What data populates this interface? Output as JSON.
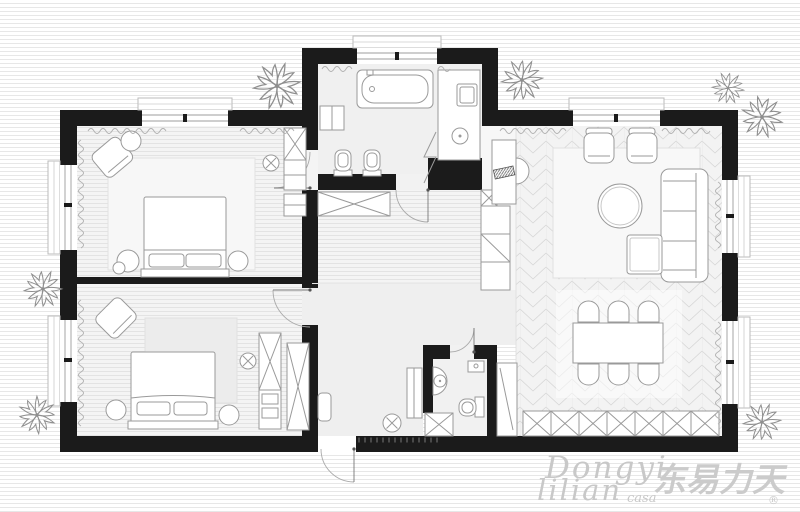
{
  "watermark": {
    "script_line1": "Dongyi",
    "script_line2": "lilian",
    "script_suffix": "casa",
    "cjk_logo": "东易力天",
    "registered_mark": "®"
  },
  "palette": {
    "wall": "#1b1b1b",
    "floor_plank": "#f4f4f4",
    "plank_line": "#dcdcdc",
    "floor_plain": "#f0f0f0",
    "chevron_line": "#d6d6d6",
    "furniture_stroke": "#9a9a9a",
    "rug": "#f8f8f8",
    "background_stripe": "#e7e7e7",
    "watermark_gray": "#c8c8c8",
    "plant_stroke": "#8f8f8f"
  },
  "plan": {
    "type": "apartment-floor-plan",
    "rooms": [
      {
        "id": "master-bedroom",
        "furniture": [
          "double-bed",
          "pillows",
          "rug",
          "armchair",
          "side-table",
          "nightstand-left",
          "nightstand-right",
          "wardrobe",
          "dresser",
          "ceiling-light"
        ]
      },
      {
        "id": "second-bedroom",
        "furniture": [
          "double-bed",
          "pillows",
          "rug",
          "armchair",
          "nightstand-left",
          "nightstand-right",
          "wardrobe",
          "wardrobe",
          "ceiling-light"
        ]
      },
      {
        "id": "bathroom",
        "furniture": [
          "bathtub",
          "wall-cabinet",
          "toilet",
          "bidet",
          "vanity-counter",
          "washing-machine",
          "sink",
          "folding-door"
        ]
      },
      {
        "id": "corridor",
        "furniture": [
          "low-wardrobe",
          "storage-box",
          "cabinet-strip",
          "tv-console",
          "tv",
          "half-round-table"
        ]
      },
      {
        "id": "entry-hall",
        "furniture": [
          "console-table",
          "bench",
          "pouf",
          "threshold-ticks"
        ]
      },
      {
        "id": "small-bathroom",
        "furniture": [
          "corner-sink",
          "toilet",
          "boiler",
          "storage-box",
          "tall-cabinet"
        ]
      },
      {
        "id": "living-room",
        "furniture": [
          "rug",
          "armchair",
          "armchair",
          "coffee-table",
          "sofa",
          "ottoman"
        ]
      },
      {
        "id": "dining-area",
        "furniture": [
          "dining-table",
          "chairs-x6",
          "kitchen-cabinet-row"
        ]
      }
    ],
    "exterior": [
      "plants-sketches",
      "window-sills",
      "entry-door-swing"
    ]
  }
}
